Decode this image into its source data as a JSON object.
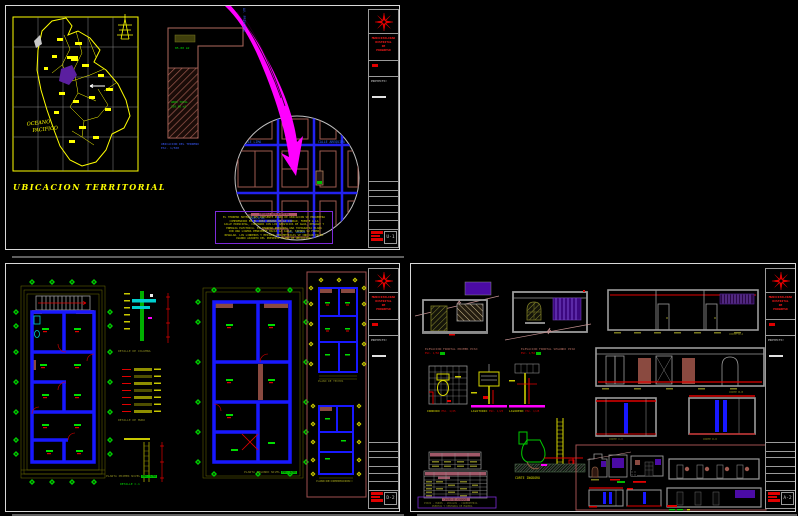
{
  "canvas": {
    "background": "#000000"
  },
  "colors": {
    "paper_border": "#d9d9d9",
    "line_yellow": "#ffff00",
    "wall_blue": "#1818ff",
    "axis_green": "#00cc00",
    "dim_olive": "#8a8a20",
    "hatch_brown": "#9e5a50",
    "arrow_magenta": "#ff00ff",
    "accent_red": "#e00000",
    "window_purple": "#4b0ba5",
    "detail_cyan": "#00cfcf",
    "memo_border_purple": "#7d2bd9",
    "table_header_mauve": "#a05868"
  },
  "titleblock": {
    "logo_lines": [
      "MUNICIPALIDAD",
      "DISTRITAL",
      "DE",
      "PROGRESO"
    ],
    "project_label": "PROYECTO:"
  },
  "sheet1": {
    "title": "UBICACION TERRITORIAL",
    "map": {
      "ocean_line1": "OCEANO",
      "ocean_line2": "PACIFICO"
    },
    "lot": {
      "area_top": "85.00 m2",
      "area_line1": "AREA TOTAL",
      "area_line2": "250.00 m2",
      "caption_line1": "UBICACION DEL TERRENO",
      "caption_line2": "ESC. 1/500",
      "street_vertical": "AV. PRINCIPAL"
    },
    "detail_circle": {
      "street1": "CALLE LIMA",
      "street2": "CALLE AREQUIPA",
      "street3": "AV. PRINCIPAL",
      "street4": "JR. UNION"
    },
    "memo": {
      "heading": "MEMORIA DESCRIPTIVA",
      "lines": [
        "EL TERRENO MATERIA DEL PRESENTE PLANO DE UBICACION SE ENCUENTRA",
        "COMPRENDIDO EN EL AREA URBANA DE LA CIUDAD, FRENTE A LA",
        "CALLE PRINCIPAL, CONTANDO CON LOS SERVICIOS DE AGUA, DESAGUE Y",
        "ENERGIA ELECTRICA. EL TERRENO PRESENTA UNA TOPOGRAFIA PLANA",
        "CON UNA LIGERA PENDIENTE HACIA LA CALLE, SIENDO SU FORMA",
        "REGULAR. LOS LINDEROS Y MEDIDAS PERIMETRICAS SE INDICAN EN EL",
        "CUADRO ADJUNTO DEL PRESENTE PLANO DE UBICACION."
      ]
    },
    "titleblock": {
      "sheet_no": "U-1"
    }
  },
  "sheet2": {
    "plan1_label": "PLANTA PRIMER NIVEL",
    "plan1_scale": "ESC. 1/50",
    "plan2_label": "PLANTA SEGUNDO NIVEL",
    "plan2_scale": "ESC. 1/50",
    "detail1_label": "DETALLE DE COLUMNA",
    "detail2_label": "DETALLE DE MURO",
    "detail3_label": "DETALLE C-1",
    "roofplan_label": "PLANO DE TECHOS",
    "foundation_label": "PLANO DE CIMENTACION",
    "titleblock": {
      "sheet_no": "D-2"
    }
  },
  "sheet3": {
    "elev1_label": "ELEVACION FRONTAL PRIMER PISO",
    "elev1_scale": "ESC. 1/50",
    "elev2_label": "ELEVACION FRONTAL SEGUNDO PISO",
    "elev2_scale": "ESC. 1/50",
    "fixture1_label": "INODORO",
    "fixture2_label": "LAVATORIO",
    "fixture3_label": "LAVADERO",
    "fixture_scale": "ESC. 1/25",
    "corte_inodoro_label": "CORTE INODORO",
    "section_a_label": "CORTE A-A",
    "section_b_label": "CORTE B-B",
    "section_c_label": "CORTE C-C",
    "section_d_label": "CORTE D-D",
    "finishes_heading": "CUADRO DE ACABADOS",
    "finishes_line1": "PISOS - MUROS - ZOCALOS - CARPINTERIA",
    "finishes_line2": "PUERTAS Y VENTANAS DE MADERA",
    "titleblock": {
      "sheet_no": "A-2"
    }
  }
}
